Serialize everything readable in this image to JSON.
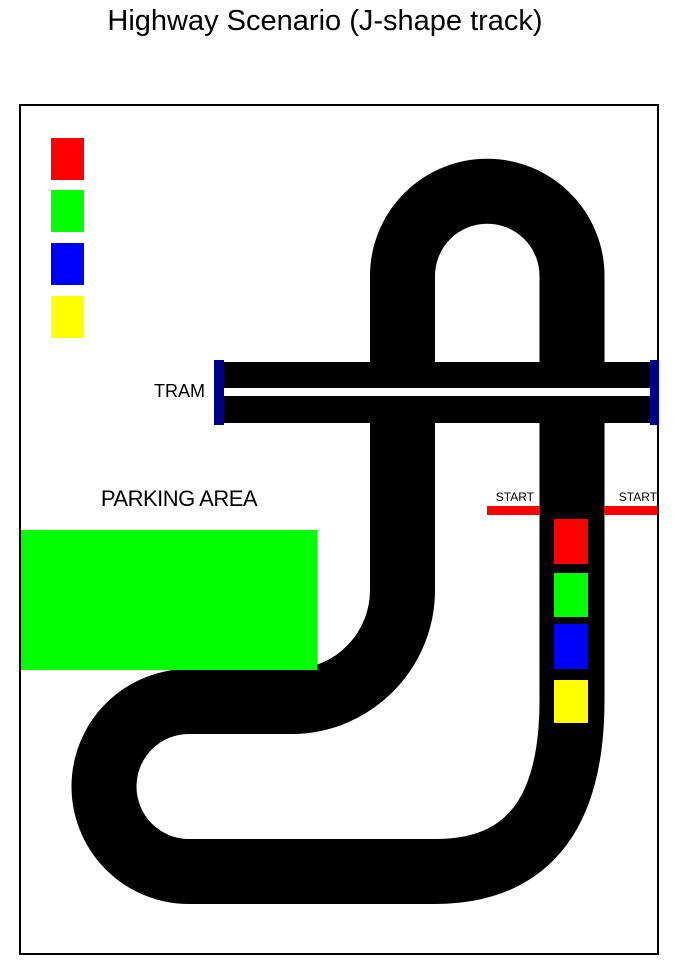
{
  "title": "Highway Scenario (J-shape track)",
  "labels": {
    "tram": "TRAM",
    "parking_area": "PARKING AREA",
    "start_left": "START",
    "start_right": "START"
  },
  "colors": {
    "track": "#000000",
    "background": "#FFFFFF",
    "canvas_border": "#000000",
    "tram_end_cap": "#00008B",
    "tram_center_line": "#FFFFFF",
    "start_line": "#FF0000",
    "parking_area": "#00FF00"
  },
  "legend": {
    "items": [
      {
        "name": "red",
        "color": "#FF0000"
      },
      {
        "name": "green",
        "color": "#00FF00"
      },
      {
        "name": "blue",
        "color": "#0000FF"
      },
      {
        "name": "yellow",
        "color": "#FFFF00"
      }
    ]
  },
  "vehicles": {
    "items": [
      {
        "name": "red",
        "color": "#FF0000"
      },
      {
        "name": "green",
        "color": "#00FF00"
      },
      {
        "name": "blue",
        "color": "#0000FF"
      },
      {
        "name": "yellow",
        "color": "#FFFF00"
      }
    ]
  }
}
